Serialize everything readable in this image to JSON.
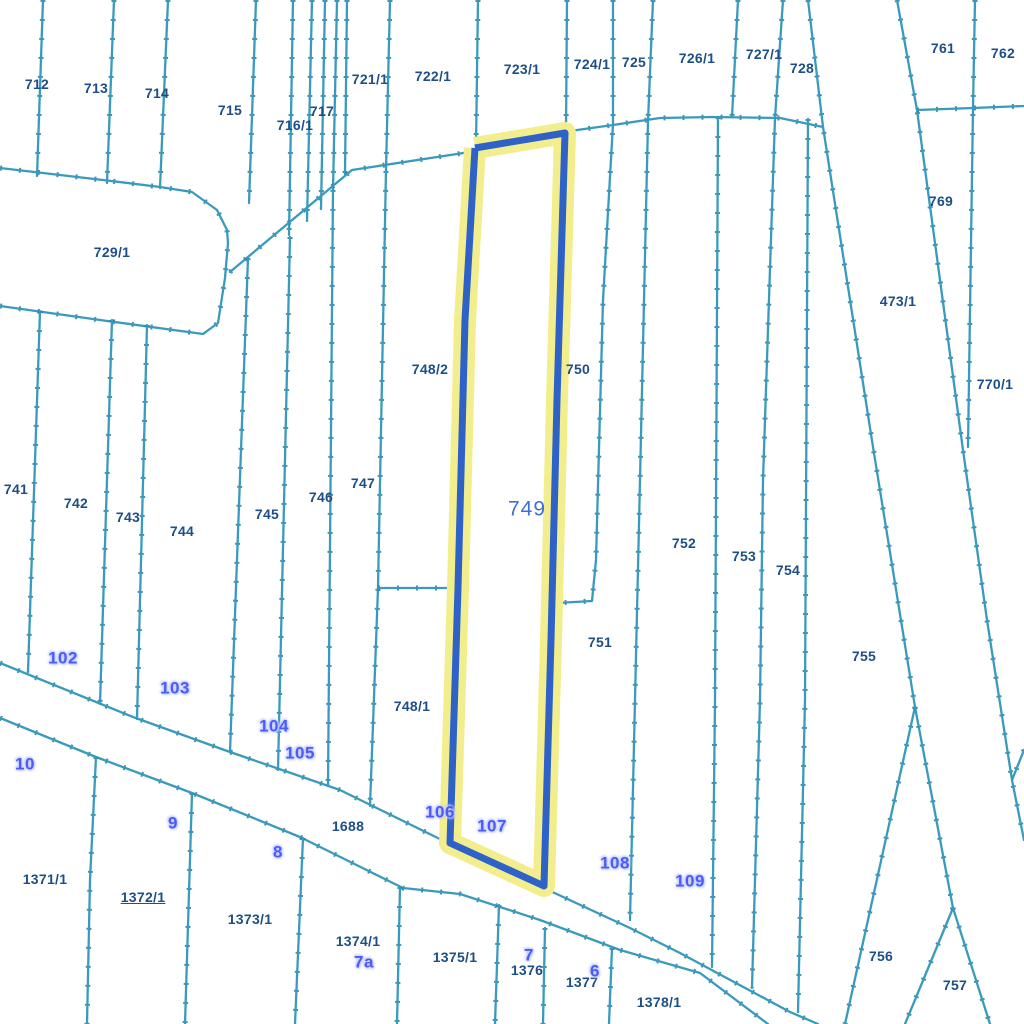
{
  "map": {
    "type": "cadastral-parcel-map",
    "background": "#ffffff",
    "line_color": "#3a9abc",
    "tick_color": "#1f7fa3",
    "parcel_label_color": "#1d4f86",
    "point_label_color": "#4a5bfa",
    "point_label_halo": "#c3cbff",
    "highlight": {
      "label": "749",
      "label_color": "#3f6fd6",
      "stroke": "#2f62c9",
      "halo": "#f2ee8d",
      "label_x": 527,
      "label_y": 509,
      "polygon": [
        [
          475,
          148
        ],
        [
          565,
          133
        ],
        [
          557,
          400
        ],
        [
          551,
          640
        ],
        [
          544,
          886
        ],
        [
          450,
          843
        ],
        [
          458,
          588
        ],
        [
          465,
          320
        ]
      ]
    },
    "parcel_labels": [
      {
        "text": "712",
        "x": 37,
        "y": 84
      },
      {
        "text": "713",
        "x": 96,
        "y": 88
      },
      {
        "text": "714",
        "x": 157,
        "y": 93
      },
      {
        "text": "715",
        "x": 230,
        "y": 110
      },
      {
        "text": "716/1",
        "x": 295,
        "y": 125
      },
      {
        "text": "717",
        "x": 322,
        "y": 111
      },
      {
        "text": "721/1",
        "x": 370,
        "y": 79
      },
      {
        "text": "722/1",
        "x": 433,
        "y": 76
      },
      {
        "text": "723/1",
        "x": 522,
        "y": 69
      },
      {
        "text": "724/1",
        "x": 592,
        "y": 64
      },
      {
        "text": "725",
        "x": 634,
        "y": 62
      },
      {
        "text": "726/1",
        "x": 697,
        "y": 58
      },
      {
        "text": "727/1",
        "x": 764,
        "y": 54
      },
      {
        "text": "728",
        "x": 802,
        "y": 68
      },
      {
        "text": "761",
        "x": 943,
        "y": 48
      },
      {
        "text": "762",
        "x": 1003,
        "y": 53
      },
      {
        "text": "769",
        "x": 941,
        "y": 201
      },
      {
        "text": "473/1",
        "x": 898,
        "y": 301
      },
      {
        "text": "770/1",
        "x": 995,
        "y": 384
      },
      {
        "text": "729/1",
        "x": 112,
        "y": 252
      },
      {
        "text": "748/2",
        "x": 430,
        "y": 369
      },
      {
        "text": "750",
        "x": 578,
        "y": 369
      },
      {
        "text": "741",
        "x": 16,
        "y": 489
      },
      {
        "text": "742",
        "x": 76,
        "y": 503
      },
      {
        "text": "743",
        "x": 128,
        "y": 517
      },
      {
        "text": "744",
        "x": 182,
        "y": 531
      },
      {
        "text": "745",
        "x": 267,
        "y": 514
      },
      {
        "text": "746",
        "x": 321,
        "y": 497
      },
      {
        "text": "747",
        "x": 363,
        "y": 483
      },
      {
        "text": "752",
        "x": 684,
        "y": 543
      },
      {
        "text": "753",
        "x": 744,
        "y": 556
      },
      {
        "text": "754",
        "x": 788,
        "y": 570
      },
      {
        "text": "751",
        "x": 600,
        "y": 642
      },
      {
        "text": "755",
        "x": 864,
        "y": 656
      },
      {
        "text": "748/1",
        "x": 412,
        "y": 706
      },
      {
        "text": "1688",
        "x": 348,
        "y": 826
      },
      {
        "text": "1371/1",
        "x": 45,
        "y": 879
      },
      {
        "text": "1372/1",
        "x": 143,
        "y": 897,
        "underline": true
      },
      {
        "text": "1373/1",
        "x": 250,
        "y": 919
      },
      {
        "text": "1374/1",
        "x": 358,
        "y": 941
      },
      {
        "text": "1375/1",
        "x": 455,
        "y": 957
      },
      {
        "text": "1376",
        "x": 527,
        "y": 970
      },
      {
        "text": "1377",
        "x": 582,
        "y": 982
      },
      {
        "text": "1378/1",
        "x": 659,
        "y": 1002
      },
      {
        "text": "756",
        "x": 881,
        "y": 956
      },
      {
        "text": "757",
        "x": 955,
        "y": 985
      }
    ],
    "point_labels": [
      {
        "text": "102",
        "x": 63,
        "y": 658
      },
      {
        "text": "103",
        "x": 175,
        "y": 688
      },
      {
        "text": "104",
        "x": 274,
        "y": 726
      },
      {
        "text": "105",
        "x": 300,
        "y": 753
      },
      {
        "text": "10",
        "x": 25,
        "y": 764
      },
      {
        "text": "9",
        "x": 173,
        "y": 823
      },
      {
        "text": "8",
        "x": 278,
        "y": 852
      },
      {
        "text": "106",
        "x": 440,
        "y": 812
      },
      {
        "text": "107",
        "x": 492,
        "y": 826
      },
      {
        "text": "108",
        "x": 615,
        "y": 863
      },
      {
        "text": "109",
        "x": 690,
        "y": 881
      },
      {
        "text": "7a",
        "x": 364,
        "y": 962
      },
      {
        "text": "7",
        "x": 529,
        "y": 955
      },
      {
        "text": "6",
        "x": 595,
        "y": 971
      }
    ],
    "boundary_lines": [
      [
        [
          43,
          0
        ],
        [
          37,
          176
        ]
      ],
      [
        [
          114,
          0
        ],
        [
          107,
          183
        ]
      ],
      [
        [
          168,
          0
        ],
        [
          160,
          188
        ]
      ],
      [
        [
          256,
          0
        ],
        [
          249,
          203
        ]
      ],
      [
        [
          293,
          0
        ],
        [
          289,
          235
        ]
      ],
      [
        [
          312,
          0
        ],
        [
          307,
          221
        ]
      ],
      [
        [
          325,
          0
        ],
        [
          321,
          209
        ]
      ],
      [
        [
          337,
          0
        ],
        [
          333,
          190
        ],
        [
          328,
          786
        ]
      ],
      [
        [
          347,
          0
        ],
        [
          345,
          174
        ]
      ],
      [
        [
          390,
          0
        ],
        [
          386,
          170
        ],
        [
          378,
          588
        ],
        [
          370,
          806
        ]
      ],
      [
        [
          478,
          0
        ],
        [
          476,
          146
        ]
      ],
      [
        [
          567,
          0
        ],
        [
          566,
          131
        ]
      ],
      [
        [
          613,
          0
        ],
        [
          613,
          124
        ],
        [
          603,
          300
        ],
        [
          596,
          560
        ],
        [
          592,
          601
        ],
        [
          557,
          603
        ]
      ],
      [
        [
          653,
          0
        ],
        [
          648,
          121
        ],
        [
          640,
          480
        ],
        [
          630,
          920
        ]
      ],
      [
        [
          738,
          0
        ],
        [
          732,
          117
        ]
      ],
      [
        [
          783,
          0
        ],
        [
          775,
          118
        ],
        [
          763,
          480
        ],
        [
          760,
          700
        ],
        [
          752,
          988
        ]
      ],
      [
        [
          718,
          117
        ],
        [
          715,
          700
        ],
        [
          712,
          967
        ]
      ],
      [
        [
          808,
          119
        ],
        [
          805,
          700
        ],
        [
          798,
          1012
        ]
      ],
      [
        [
          808,
          0
        ],
        [
          823,
          127
        ],
        [
          873,
          447
        ],
        [
          915,
          707
        ]
      ],
      [
        [
          915,
          707
        ],
        [
          845,
          1024
        ]
      ],
      [
        [
          915,
          707
        ],
        [
          953,
          908
        ]
      ],
      [
        [
          953,
          908
        ],
        [
          905,
          1024
        ]
      ],
      [
        [
          953,
          908
        ],
        [
          990,
          1024
        ]
      ],
      [
        [
          897,
          0
        ],
        [
          917,
          110
        ],
        [
          963,
          450
        ],
        [
          987,
          620
        ],
        [
          1012,
          780
        ]
      ],
      [
        [
          1024,
          750
        ],
        [
          1012,
          780
        ],
        [
          1024,
          840
        ]
      ],
      [
        [
          975,
          0
        ],
        [
          973,
          108
        ],
        [
          968,
          447
        ]
      ],
      [
        [
          917,
          110
        ],
        [
          973,
          108
        ],
        [
          1024,
          106
        ]
      ],
      [
        [
          230,
          272
        ],
        [
          352,
          170
        ],
        [
          470,
          152
        ],
        [
          570,
          131
        ],
        [
          613,
          125
        ],
        [
          660,
          118
        ],
        [
          713,
          117
        ],
        [
          780,
          118
        ],
        [
          823,
          127
        ]
      ],
      [
        [
          0,
          168
        ],
        [
          103,
          180
        ],
        [
          160,
          187
        ],
        [
          192,
          192
        ],
        [
          217,
          210
        ],
        [
          227,
          230
        ],
        [
          228,
          243
        ],
        [
          225,
          278
        ],
        [
          218,
          323
        ],
        [
          203,
          334
        ]
      ],
      [
        [
          0,
          306
        ],
        [
          100,
          320
        ],
        [
          203,
          334
        ]
      ],
      [
        [
          40,
          311
        ],
        [
          28,
          672
        ]
      ],
      [
        [
          112,
          320
        ],
        [
          100,
          704
        ]
      ],
      [
        [
          147,
          325
        ],
        [
          137,
          719
        ]
      ],
      [
        [
          248,
          258
        ],
        [
          230,
          752
        ]
      ],
      [
        [
          290,
          237
        ],
        [
          278,
          770
        ]
      ],
      [
        [
          378,
          588
        ],
        [
          458,
          588
        ]
      ],
      [
        [
          0,
          663
        ],
        [
          133,
          717
        ],
        [
          230,
          752
        ],
        [
          340,
          790
        ],
        [
          448,
          843
        ]
      ],
      [
        [
          548,
          890
        ],
        [
          630,
          928
        ],
        [
          680,
          953
        ],
        [
          790,
          1012
        ],
        [
          818,
          1024
        ]
      ],
      [
        [
          0,
          718
        ],
        [
          96,
          757
        ],
        [
          192,
          793
        ],
        [
          300,
          837
        ],
        [
          403,
          888
        ],
        [
          460,
          894
        ],
        [
          540,
          920
        ],
        [
          620,
          950
        ],
        [
          700,
          973
        ],
        [
          768,
          1024
        ]
      ],
      [
        [
          96,
          757
        ],
        [
          90,
          880
        ],
        [
          87,
          1024
        ]
      ],
      [
        [
          192,
          793
        ],
        [
          185,
          1024
        ]
      ],
      [
        [
          303,
          838
        ],
        [
          295,
          1024
        ]
      ],
      [
        [
          400,
          887
        ],
        [
          397,
          1024
        ]
      ],
      [
        [
          499,
          905
        ],
        [
          495,
          1024
        ]
      ],
      [
        [
          545,
          928
        ],
        [
          543,
          1024
        ]
      ],
      [
        [
          612,
          948
        ],
        [
          609,
          1024
        ]
      ]
    ]
  }
}
